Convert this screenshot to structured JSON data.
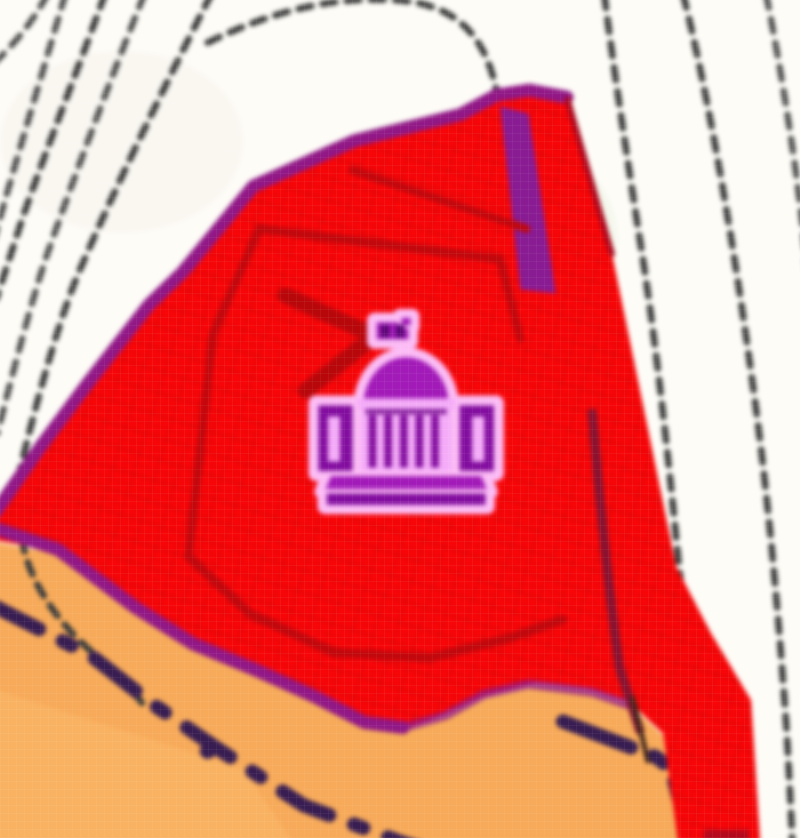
{
  "meta": {
    "type": "map-screenshot",
    "description": "Heavily magnified low-resolution map tile showing a red hatched landmark area with a government (capitol dome) building icon, tan land-use area below, dashed black footpaths on white ground and a dark dashed administrative boundary."
  },
  "map": {
    "aria_label": "Map area with red landmark zone, capitol building icon, tan land-use area, dashed paths and boundary lines",
    "icon": {
      "name": "capitol-building-icon",
      "meaning": "government / historic domed building point of interest",
      "aria_label": "Capitol building point of interest icon"
    },
    "features": {
      "white_ground": "unmapped white background",
      "footpaths": "thin black dashed path lines, upper-left fan and right-side curves",
      "red_area": "red cross-hatched landmark/restricted area polygon",
      "purple_edge": "dark purple border along left, top and lower edge of red area",
      "building_outlines": "dark red building footprint outlines inside red area",
      "orange_area": "tan-orange land-use area across the bottom",
      "admin_boundary": "thick dark violet dash-dot boundary lines crossing the orange area",
      "maroon_line": "dark maroon inner line right of the icon"
    },
    "colors": {
      "ground_white": "#fbfaf5",
      "landmark_fill": "#e90c0e",
      "landmark_hatch": "#c80a0c",
      "purple_border": "#8a1c80",
      "inner_purple_streak": "#7d2194",
      "building_outline": "#b30d12",
      "maroon_inner_line": "#7e1733",
      "landuse_fill": "#f0aa60",
      "landuse_fill_light": "#f4b870",
      "boundary_navy": "#382050",
      "footpath_black": "#3c3c3c",
      "icon_halo_pink": "#f6bcf0",
      "icon_light_pink": "#efadf2",
      "icon_main_purple": "#9a1fae",
      "icon_dark_purple": "#7c1296",
      "icon_deep_purple": "#560a6e"
    }
  }
}
